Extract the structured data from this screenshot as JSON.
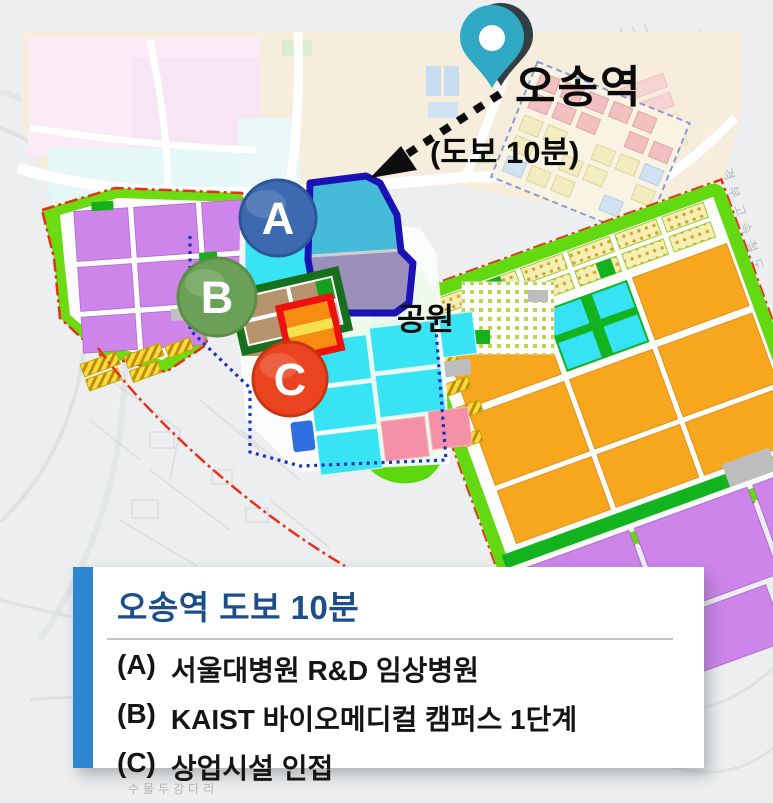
{
  "map": {
    "station_label": "오송역",
    "walk_time_label": "(도보 10분)",
    "park_label": "공원",
    "railway_label": "경부고속철도",
    "bridge_label": "수물두강다리",
    "markers": [
      {
        "id": "A",
        "color": "#3d69b0"
      },
      {
        "id": "B",
        "color": "#6ba156"
      },
      {
        "id": "C",
        "color": "#e9431f"
      }
    ],
    "pin_color": "#2fa9c4"
  },
  "legend": {
    "title": "오송역 도보 10분",
    "accent_color": "#2e86d1",
    "title_color": "#1d4e89",
    "items": [
      {
        "key": "(A)",
        "label": "서울대병원 R&D 임상병원"
      },
      {
        "key": "(B)",
        "label": "KAIST 바이오메디컬 캠퍼스 1단계"
      },
      {
        "key": "(C)",
        "label": "상업시설 인접"
      }
    ]
  },
  "colors": {
    "zone_purple": "#cd85ea",
    "zone_cyan": "#38e3f3",
    "zone_orange": "#f7a71e",
    "zone_green": "#63d911",
    "zone_tan": "#b5936d",
    "zone_pink": "#f591a6",
    "area_a_outline": "#1a12b4",
    "area_b_outline": "#17701d",
    "area_c_outline": "#ee0f0f",
    "boundary_red": "#e63119"
  }
}
